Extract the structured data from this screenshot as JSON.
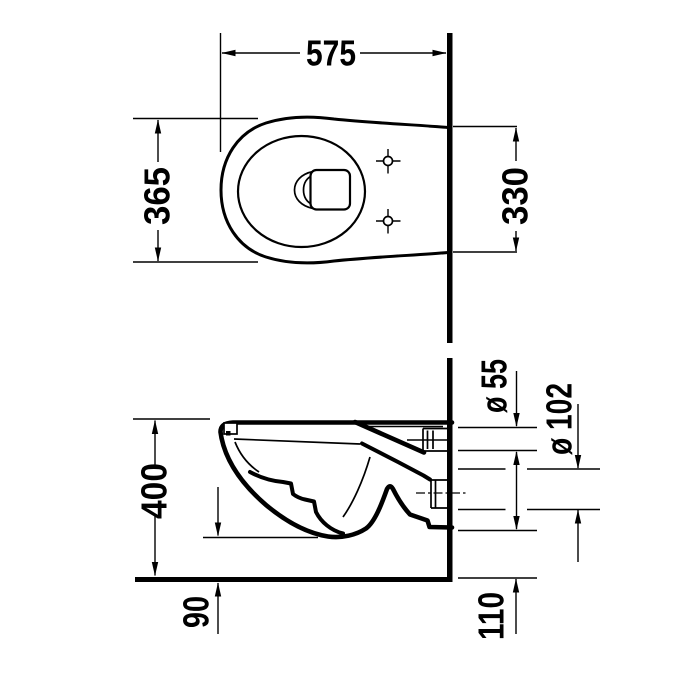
{
  "drawing": {
    "title": "Wall-hung toilet technical drawing",
    "colors": {
      "ink": "#000000",
      "background": "#ffffff"
    },
    "dimensions": {
      "overall_depth": "575",
      "bowl_width": "365",
      "rear_width": "330",
      "height": "400",
      "supply_diameter": "ø 55",
      "outlet_diameter": "ø 102",
      "underside_clearance": "90",
      "outlet_height": "110"
    }
  }
}
